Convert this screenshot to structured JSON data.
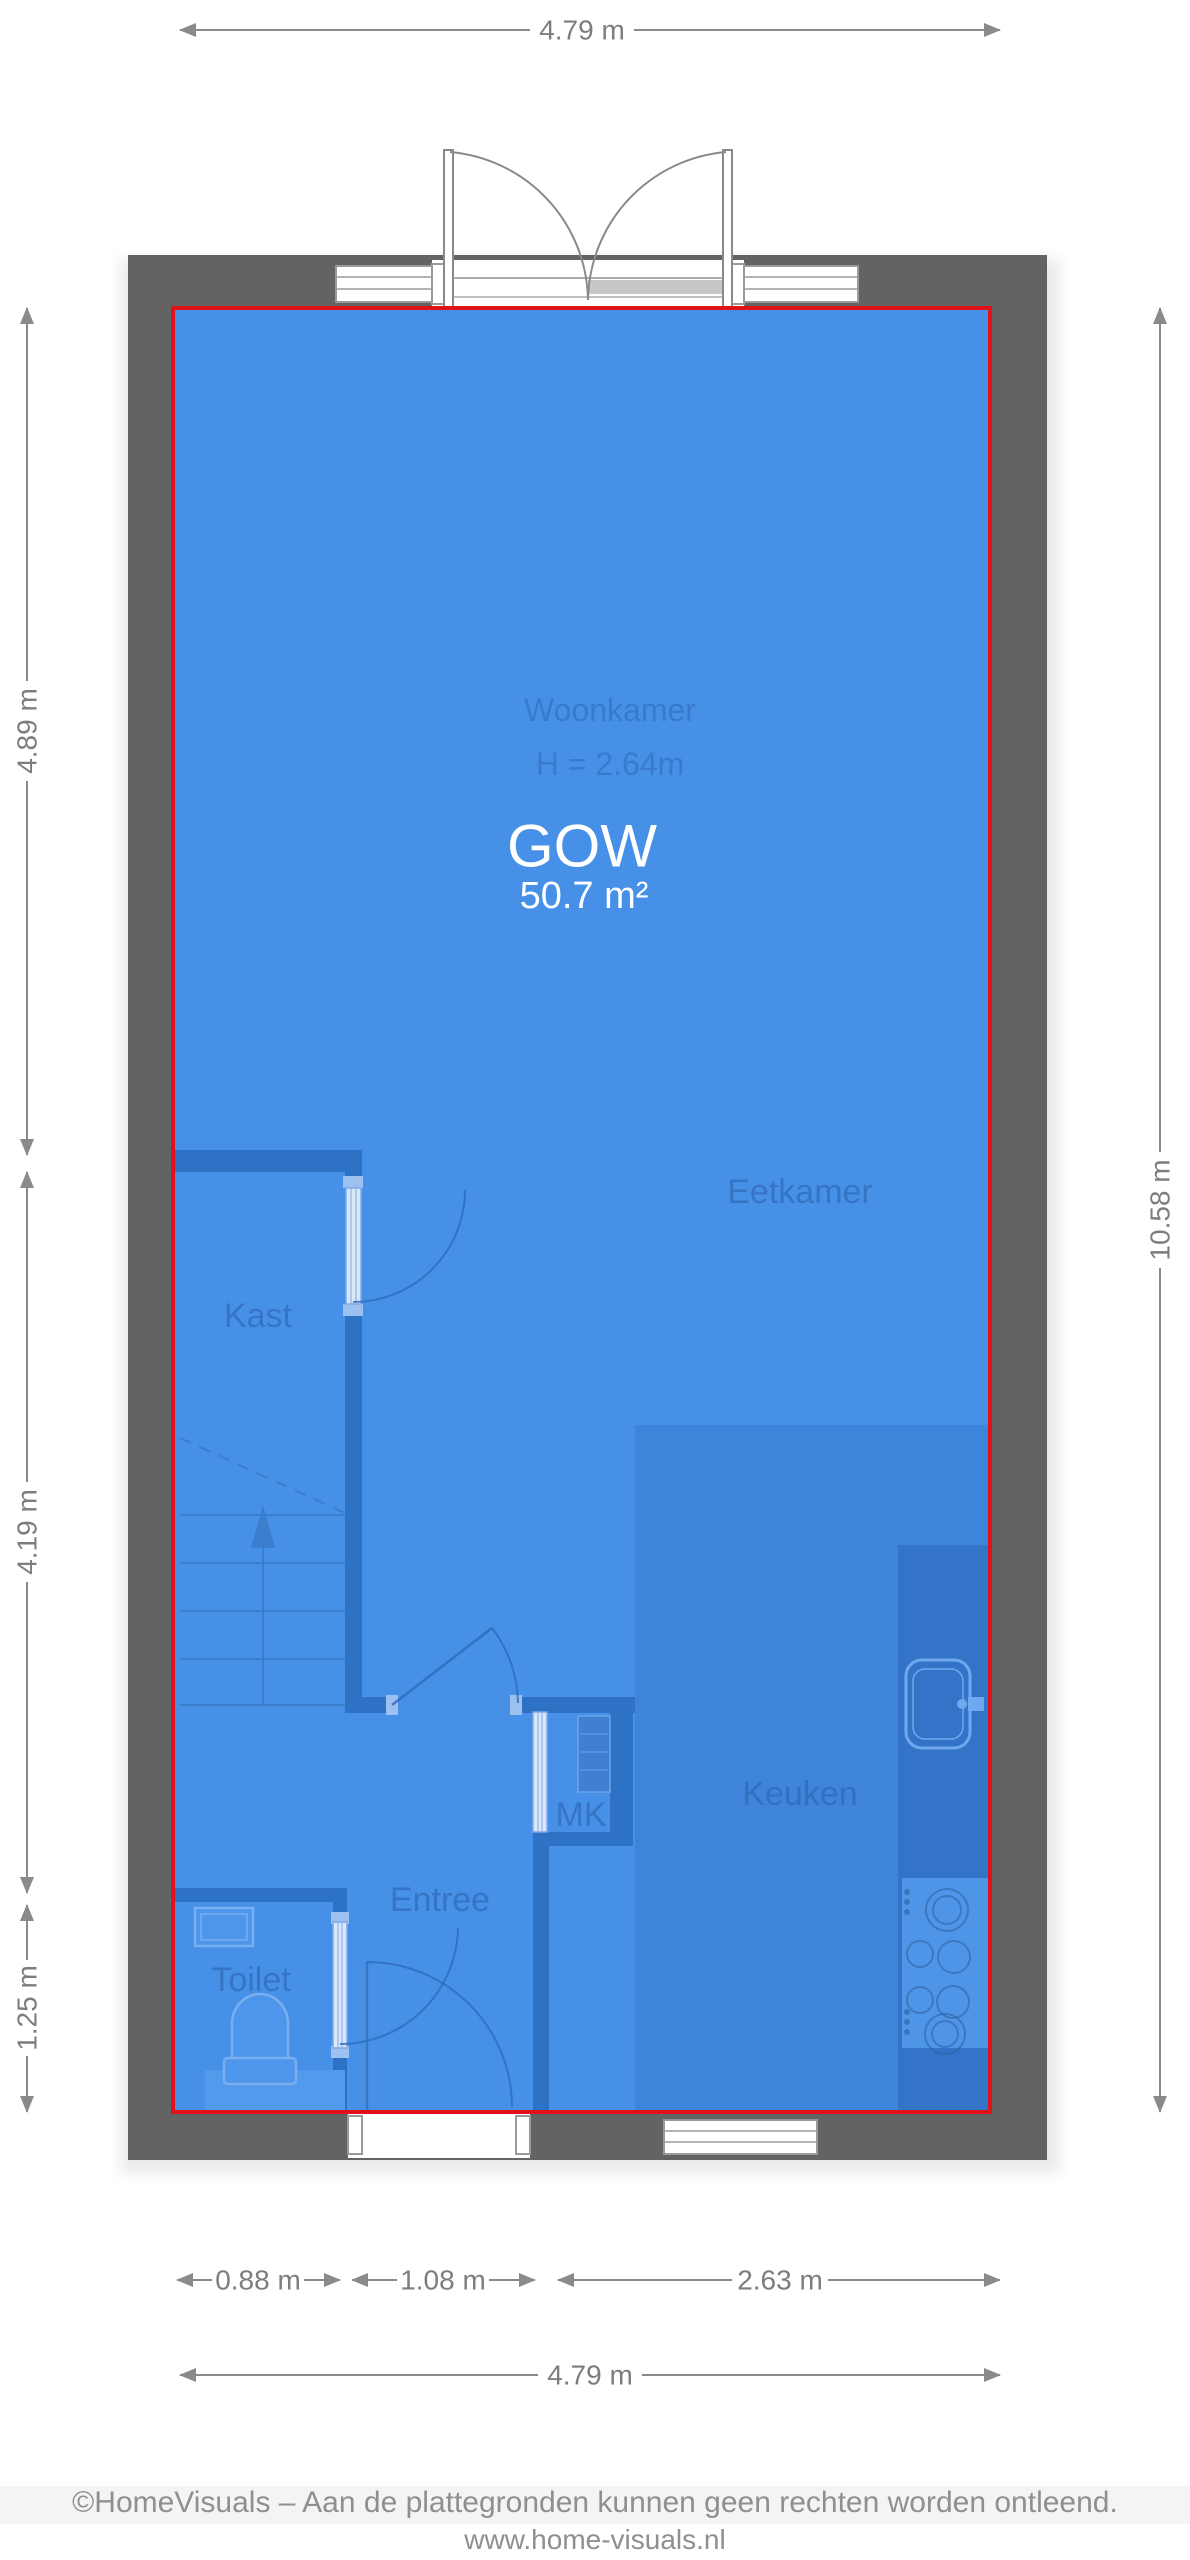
{
  "colors": {
    "wall_gray": "#636363",
    "outline_red": "#e01119",
    "floor_blue": "#4690e8",
    "kitchen_floor_blue": "#3d84da",
    "interior_wall_blue": "#2e72c6",
    "counter_blue": "#3474c8",
    "fixture_light_blue": "#4e95e8",
    "dimension_gray": "#7d7d7d",
    "footer_gray": "#8f8f8f",
    "label_blue": "#2d64ae",
    "text_white": "#ffffff"
  },
  "area": {
    "code": "GOW",
    "size": "50.7 m²"
  },
  "rooms": {
    "woonkamer": "Woonkamer",
    "ceiling_height": "H = 2.64m",
    "eetkamer": "Eetkamer",
    "kast": "Kast",
    "keuken": "Keuken",
    "mk": "MK",
    "entree": "Entree",
    "toilet": "Toilet"
  },
  "dimensions": {
    "top_width": "4.79 m",
    "right_height": "10.58 m",
    "left_segments": [
      "4.89 m",
      "4.19 m",
      "1.25 m"
    ],
    "bottom_segments": [
      "0.88 m",
      "1.08 m",
      "2.63 m"
    ],
    "bottom_total": "4.79 m"
  },
  "footer": {
    "copyright": "©HomeVisuals – Aan de plattegronden kunnen geen rechten worden ontleend.",
    "website": "www.home-visuals.nl"
  }
}
